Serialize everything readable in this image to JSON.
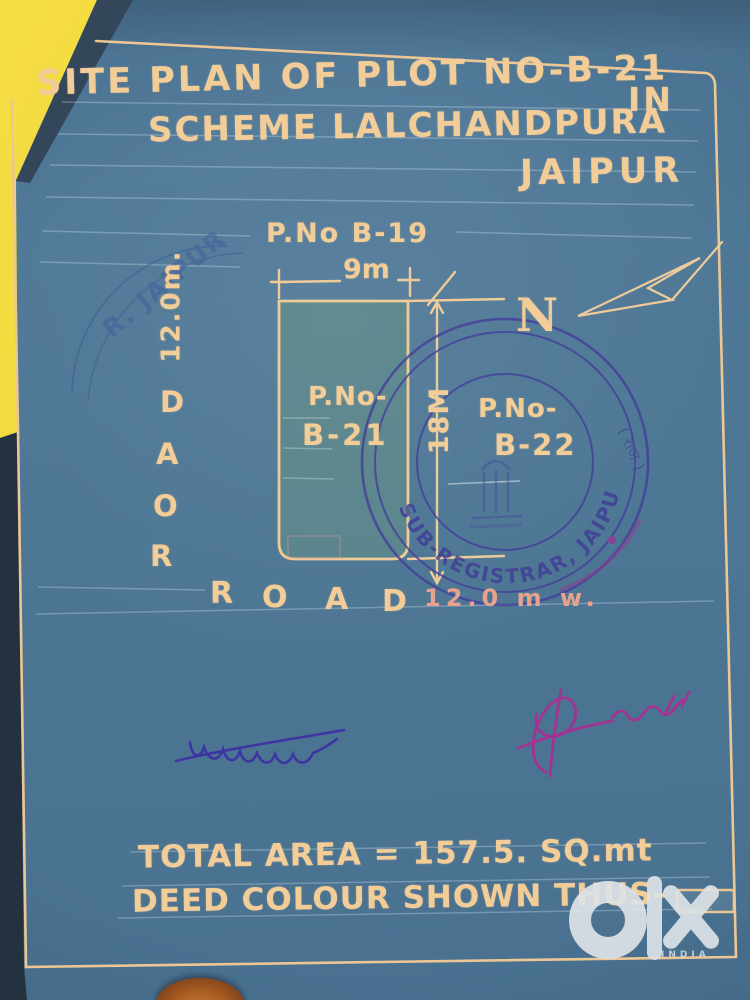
{
  "title": {
    "line1": "SITE PLAN OF PLOT NO-B-21",
    "in": "IN",
    "line2": "SCHEME LALCHANDPURA",
    "line3": "JAIPUR"
  },
  "plan": {
    "adjacent_plot_top": "P.No B-19",
    "width_dim": "9m",
    "height_dim": "18M",
    "road_left": {
      "letters": [
        "R",
        "O",
        "A",
        "D"
      ],
      "dim": "12.0m."
    },
    "plot": {
      "line1": "P.No-",
      "line2": "B-21"
    },
    "adjacent_plot_right": {
      "line1": "P.No-",
      "line2": "B-22"
    },
    "north": "N",
    "road_bottom": {
      "letters": [
        "R",
        "O",
        "A",
        "D"
      ],
      "dim": "12.0 m w."
    }
  },
  "stamps": {
    "registrar": {
      "text": "SUB-REGISTRAR, JAIPUR-V",
      "side_text": "( राज )"
    },
    "corner": {
      "text": "R. JAIPUR"
    }
  },
  "footer": {
    "total_area": "TOTAL AREA = 157.5. SQ.mt",
    "deed_colour": "DEED COLOUR SHOWN THUS-"
  },
  "watermark": {
    "brand": "olx",
    "country": "INDIA"
  },
  "colors": {
    "paper": "#4d7795",
    "ink": "#f2cd98",
    "stamp_ink": "#433d9a",
    "plot_wash": "#5a8480",
    "backdrop_yellow": "#f2dc3d",
    "signature_left_ink": "#3c35a2",
    "signature_right_ink": "#a23393"
  }
}
